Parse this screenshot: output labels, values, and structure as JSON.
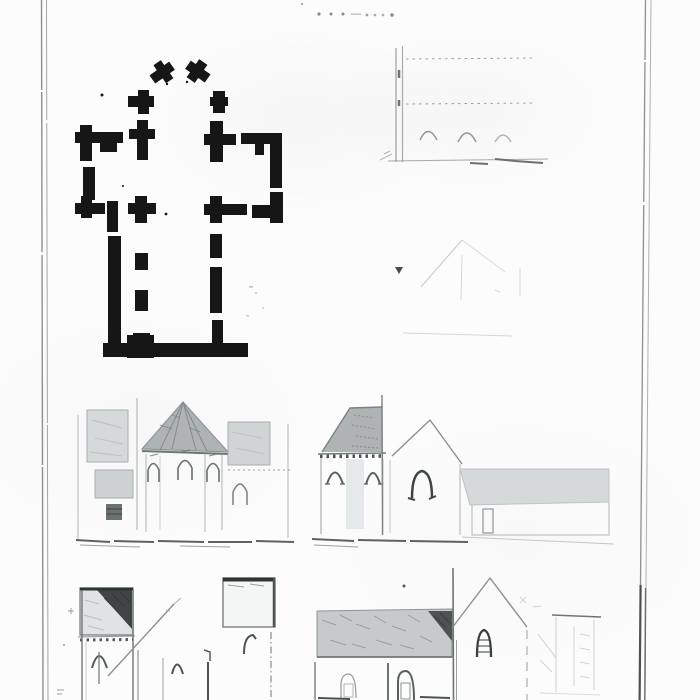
{
  "plate": {
    "kind": "scanned architectural plate, church plan and elevations",
    "caption_note": "illegible faded dotted caption at top",
    "background": "#fcfcfc",
    "border_color": "#8f8f8f",
    "border_color_light": "#b0b0b0",
    "border_dark_segment": "#4f4f4f",
    "ink": "#161616",
    "pencil": "#9aa0a0",
    "pencil_faint": "#c9cdcd",
    "pencil_dark": "#4d5353",
    "ground_scribble": "#5d6363",
    "shade_light": "#d6d9d9",
    "shade_mid": "#aeb3b3",
    "shade_roof": "#c6caca",
    "shade_dark": "#3f4444",
    "caption_dot_color": "#8a8a8a"
  },
  "figures": [
    {
      "id": "floor-plan",
      "label": "cruciform church ground plan in black ink"
    },
    {
      "id": "arcade-elevation",
      "label": "faint interior arcade elevation with three arches"
    },
    {
      "id": "faint-gable",
      "label": "very faint gable roof sketch"
    },
    {
      "id": "east-end-elevation",
      "label": "east end elevation with conical apse roof"
    },
    {
      "id": "tower-and-gable-elevation",
      "label": "pyramidal tower and gable end elevation"
    },
    {
      "id": "outbuilding-sketch",
      "label": "low outbuilding with long roof"
    },
    {
      "id": "bottom-left-elevation",
      "label": "tower elevation with dark roof, cropped at bottom"
    },
    {
      "id": "bottom-right-elevation",
      "label": "long shaded nave roof with gable end, cropped"
    },
    {
      "id": "corner-sketch",
      "label": "faint small building sketch at lower right"
    }
  ]
}
